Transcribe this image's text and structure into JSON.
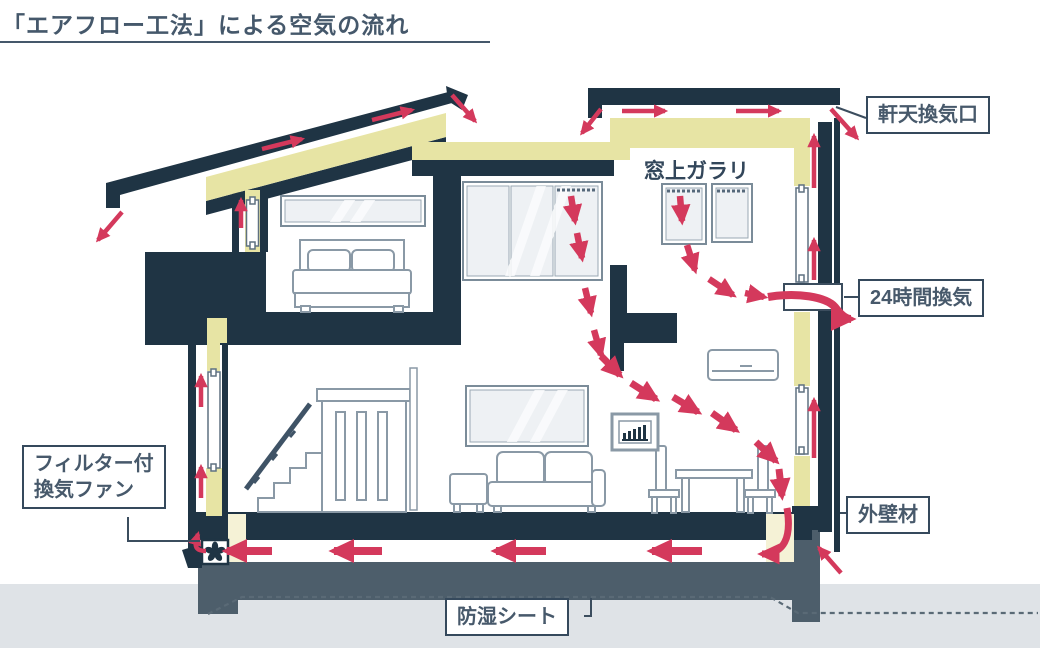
{
  "title": "「エアフロー工法」による空気の流れ",
  "callouts": {
    "eave_vent": "軒天換気口",
    "window_louver": "窓上ガラリ",
    "ventilation_24h": "24時間換気",
    "exterior_wall_material": "外壁材",
    "filter_fan": {
      "line1": "フィルター付",
      "line2": "換気ファン"
    },
    "moisture_sheet": "防湿シート"
  },
  "colors": {
    "structure_navy": "#1f3444",
    "insulation_yellow": "#e7e4a4",
    "insulation_pale": "#f5f2d6",
    "airflow_red": "#d4395c",
    "foundation_slate": "#4d5e6b",
    "ground_gray": "#dfe3e7",
    "label_text": "#47596b"
  }
}
